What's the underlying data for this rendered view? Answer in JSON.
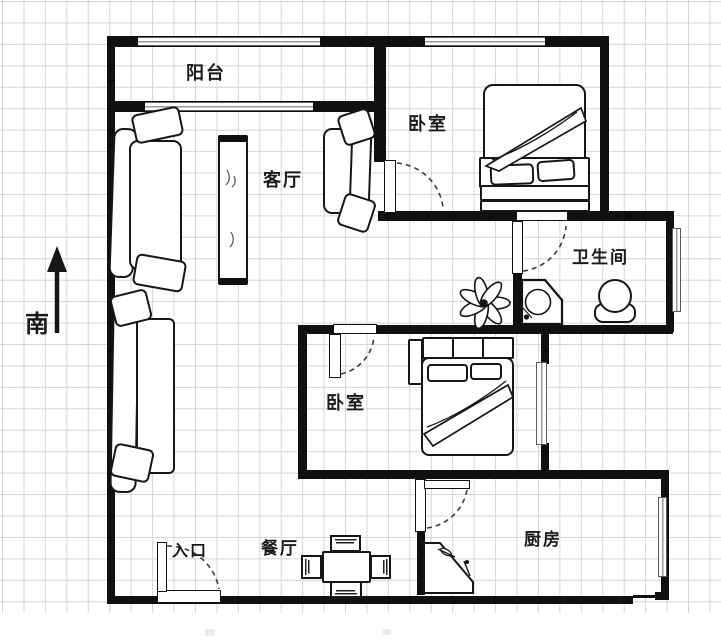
{
  "plan": {
    "rooms": [
      {
        "id": "balcony",
        "label": "阳台"
      },
      {
        "id": "bedroom-1",
        "label": "卧室"
      },
      {
        "id": "living-room",
        "label": "客厅"
      },
      {
        "id": "bathroom",
        "label": "卫生间"
      },
      {
        "id": "bedroom-2",
        "label": "卧室"
      },
      {
        "id": "entrance",
        "label": "入口"
      },
      {
        "id": "dining-room",
        "label": "餐厅"
      },
      {
        "id": "kitchen",
        "label": "厨房"
      }
    ],
    "compass": {
      "label": "南",
      "direction": "south-up"
    },
    "colors": {
      "wall": "#101010",
      "grid": "#d5d5d5",
      "background": "#ffffff",
      "furniture_outline": "#161616",
      "door_arc": "#3a3a3a",
      "window_frame": "#5a5a5a"
    }
  }
}
